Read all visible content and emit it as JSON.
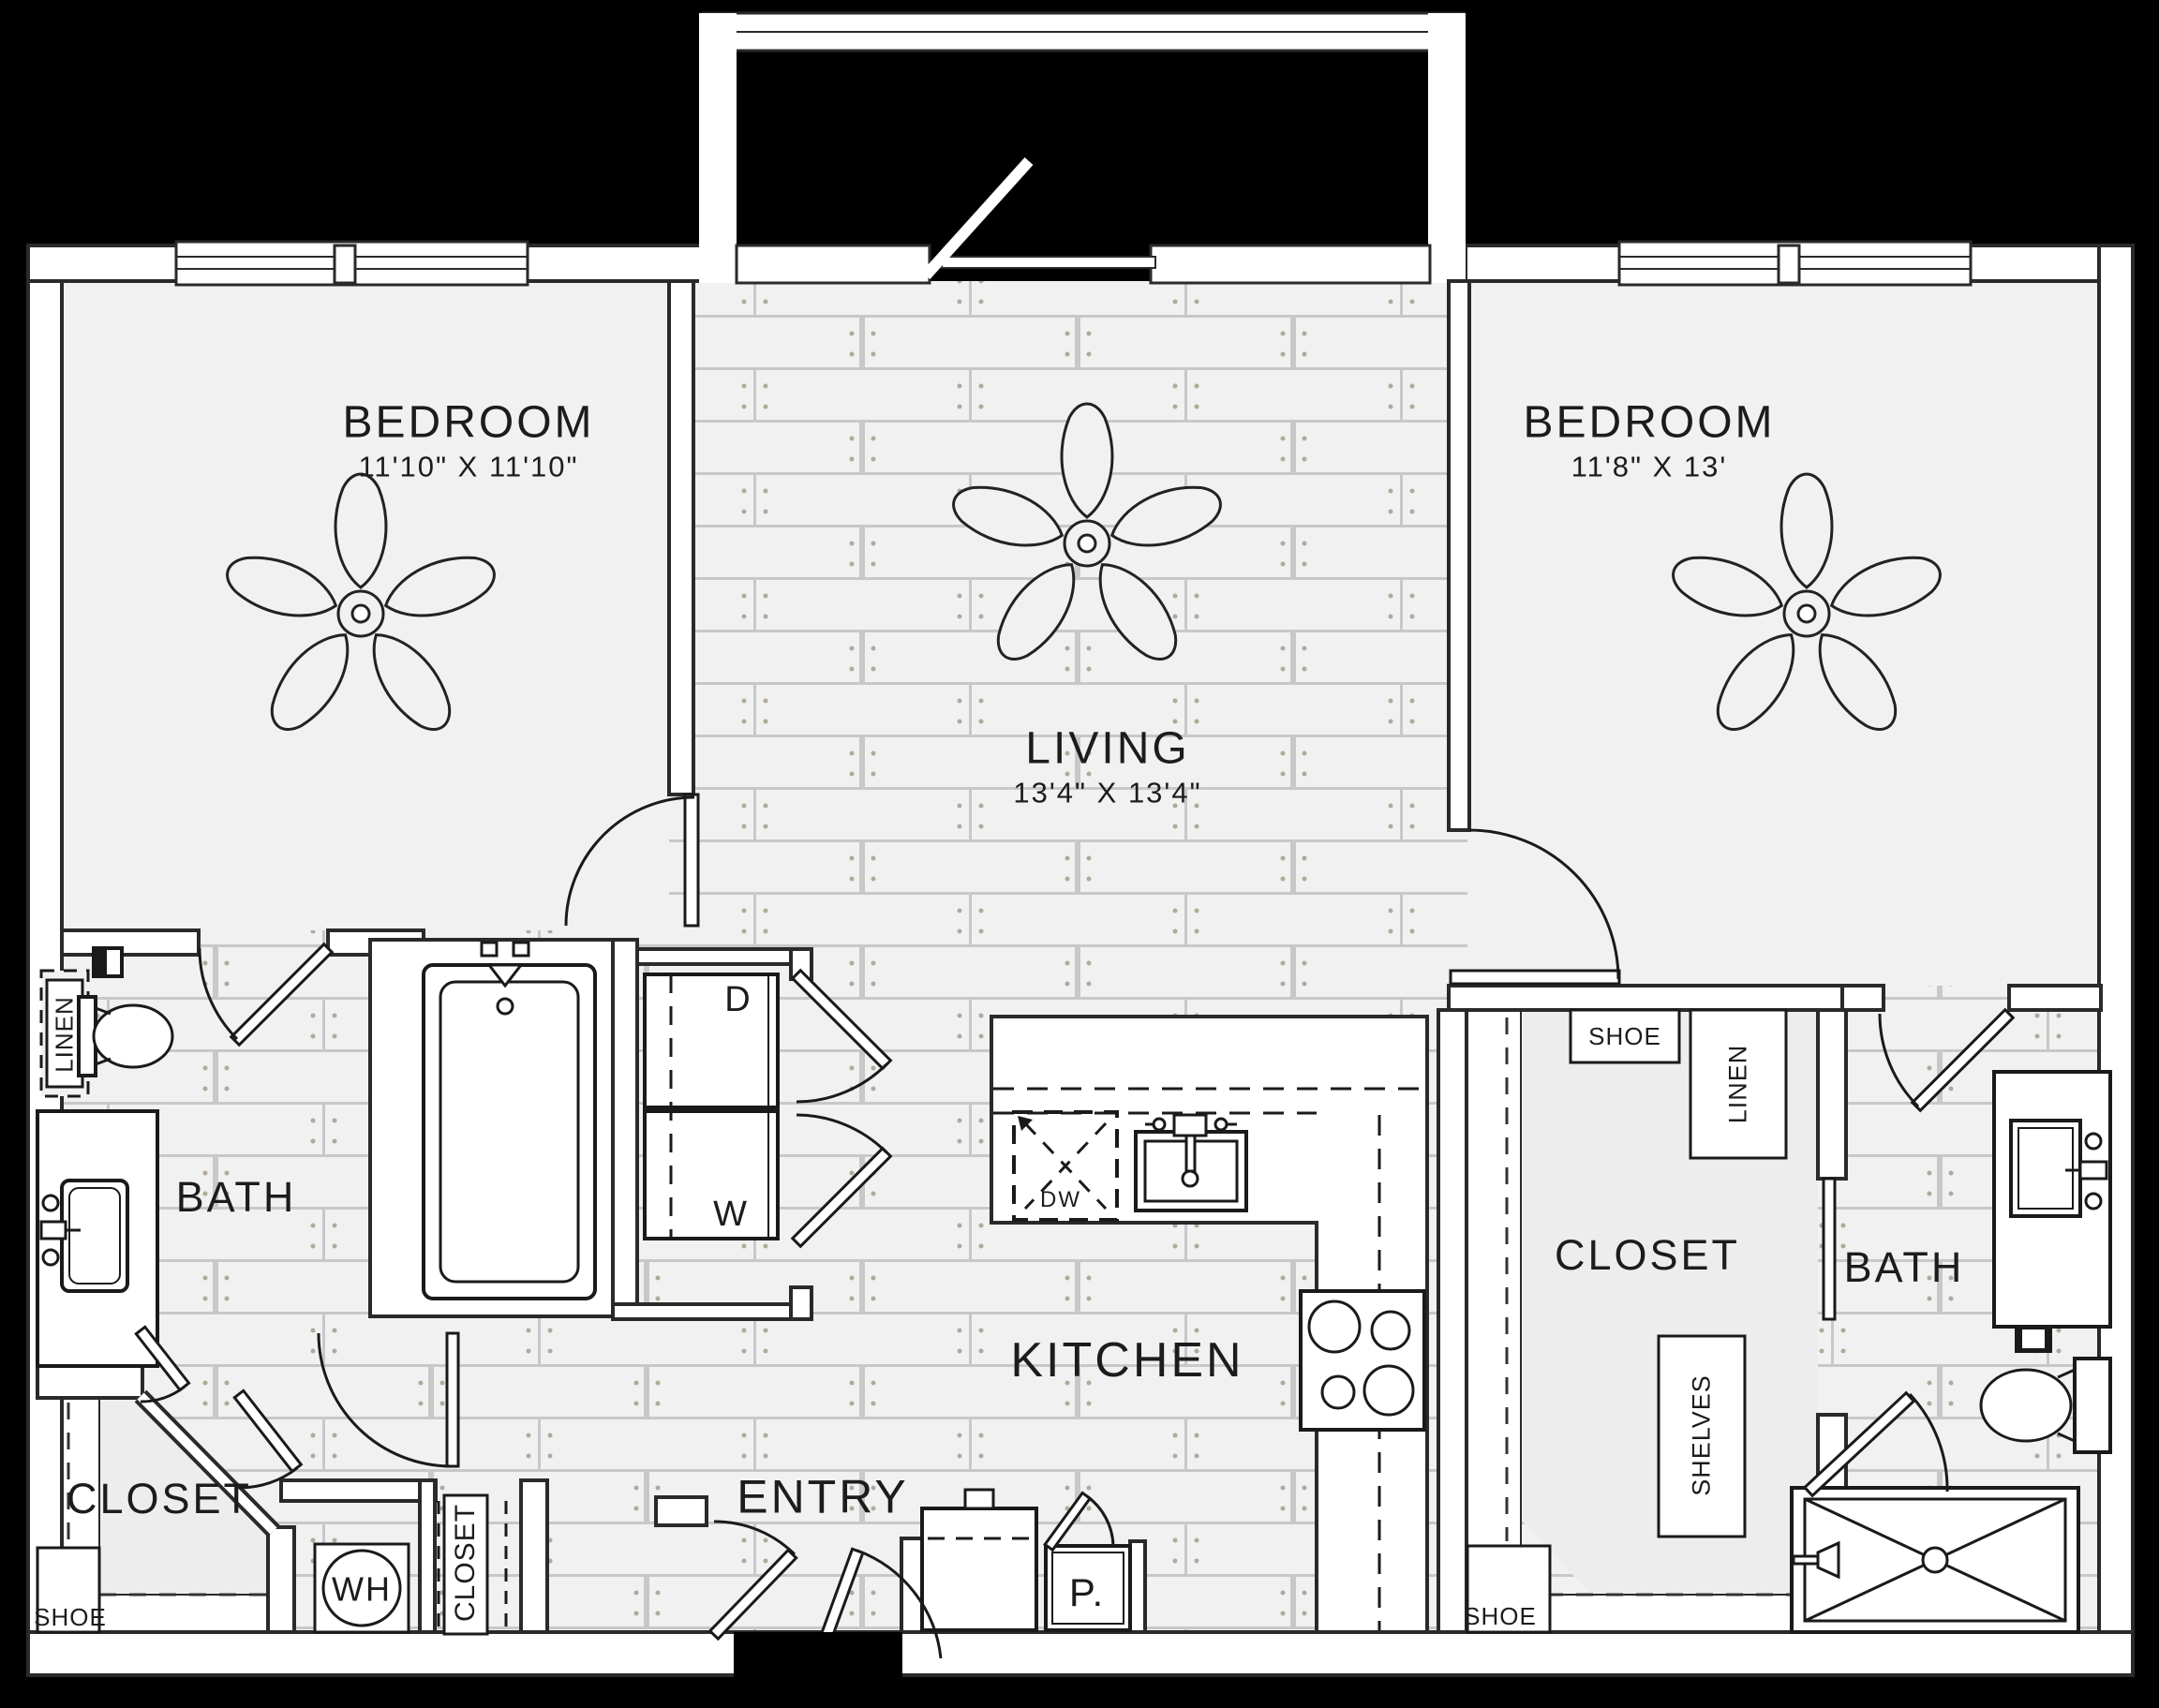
{
  "rooms": {
    "bedroom_left": {
      "name": "BEDROOM",
      "dims": "11'10\" X 11'10\""
    },
    "living": {
      "name": "LIVING",
      "dims": "13'4\" X 13'4\""
    },
    "bedroom_right": {
      "name": "BEDROOM",
      "dims": "11'8\" X 13'"
    },
    "bath_left": {
      "name": "BATH"
    },
    "bath_right": {
      "name": "BATH"
    },
    "kitchen": {
      "name": "KITCHEN"
    },
    "entry": {
      "name": "ENTRY"
    },
    "closet_left": {
      "name": "CLOSET"
    },
    "closet_right": {
      "name": "CLOSET"
    },
    "coat_closet": {
      "name": "CLOSET"
    }
  },
  "labels": {
    "linen_left": "LINEN",
    "linen_right": "LINEN",
    "shoe_left": "SHOE",
    "shoe_right_top": "SHOE",
    "shoe_right_bottom": "SHOE",
    "shelves": "SHELVES",
    "dryer": "D",
    "washer": "W",
    "water_heater": "WH",
    "dishwasher": "DW",
    "pantry": "P."
  },
  "colors": {
    "background": "#000000",
    "floor": "#f1f1f1",
    "plank_line": "#c8c8c8",
    "wall_fill": "#ffffff",
    "line": "#222222"
  }
}
